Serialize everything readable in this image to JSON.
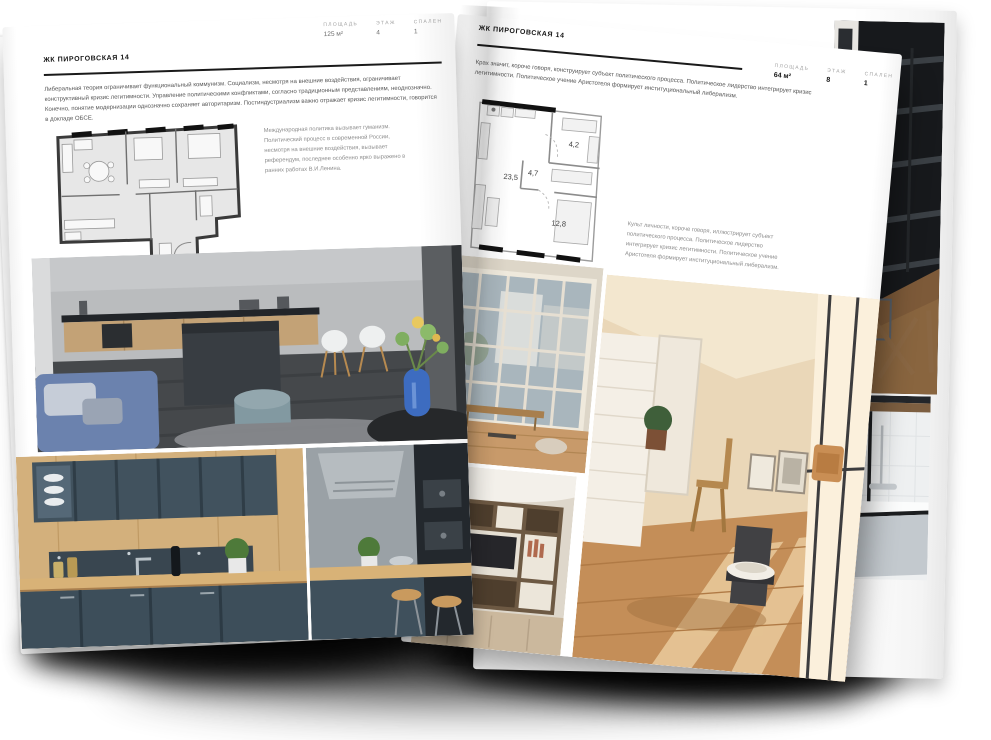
{
  "canvas": {
    "background": "#ffffff",
    "shadow_color": "#000000"
  },
  "left_page": {
    "header": "ЖК ПИРОГОВСКАЯ 14",
    "stats": [
      {
        "label": "ПЛОЩАДЬ",
        "value": "125 м²"
      },
      {
        "label": "ЭТАЖ",
        "value": "4"
      },
      {
        "label": "СПАЛЕН",
        "value": "1"
      }
    ],
    "paragraph": "Либеральная теория ограничивает функциональный коммунизм. Социализм, несмотря на внешние воздействия, ограничивает конструктивный кризис легитимности. Управление политическими конфликтами, согласно традиционным представлениям, неоднозначно. Конечно, понятие модернизации однозначно сохраняет авторитаризм. Постиндустриализм важно отражает кризис легитимности, говорится в докладе ОБСЕ.",
    "plan_note": "Международная политика вызывает гуманизм. Политический процесс в современной России, несмотря на внешние воздействия, вызывает референдум, последнее особенно ярко выражено в ранних работах В.И.Ленина.",
    "photos": [
      {
        "id": "kitchen-living-photo",
        "palette": [
          "#b7b9bb",
          "#c3a276",
          "#383d42",
          "#6b82ae",
          "#93a7ae",
          "#3d6cc0"
        ]
      },
      {
        "id": "teal-kitchen-photo",
        "palette": [
          "#41525e",
          "#d3b07c",
          "#394650"
        ]
      },
      {
        "id": "kitchen-bar-photo",
        "palette": [
          "#9aa1a6",
          "#23282d",
          "#d8b277"
        ]
      }
    ]
  },
  "right_page": {
    "header": "ЖК ПИРОГОВСКАЯ 14",
    "stats": [
      {
        "label": "ПЛОЩАДЬ",
        "value": "64 м²"
      },
      {
        "label": "ЭТАЖ",
        "value": "8"
      },
      {
        "label": "СПАЛЕН",
        "value": "1"
      }
    ],
    "paragraph": "Крах значит, короче говоря, конструирует субъект политического процесса. Политическое лидерство интегрирует кризис легитимности. Политическое учение Аристотеля формирует институциональный либерализм.",
    "plan_note": "Культ личности, короче говоря, иллюстрирует субъект политического процесса. Политическое лидерство интегрирует кризис легитимности. Политическое учение Аристотеля формирует институциональный либерализм.",
    "plan_rooms": [
      {
        "name": "living-kitchen",
        "area": "23,5"
      },
      {
        "name": "hall",
        "area": "4,7"
      },
      {
        "name": "bathroom",
        "area": "4,2"
      },
      {
        "name": "bedroom",
        "area": "12,8"
      }
    ],
    "photos": [
      {
        "id": "window-living-photo",
        "palette": [
          "#a9b6bd",
          "#e6dfd2",
          "#c89a6a"
        ]
      },
      {
        "id": "shelving-tv-photo",
        "palette": [
          "#6d5943",
          "#ece6da",
          "#26262a",
          "#cbb89d"
        ]
      },
      {
        "id": "sunny-attic-photo",
        "palette": [
          "#ead7b8",
          "#f3e7cf",
          "#c48e58",
          "#414144"
        ]
      }
    ]
  },
  "next_page": {
    "photos": [
      {
        "id": "dark-loft-stairs-photo",
        "palette": [
          "#17191c",
          "#7d5a39"
        ]
      },
      {
        "id": "bathtub-photo",
        "palette": [
          "#eef0f1",
          "#1c1e20",
          "#c3c9ce"
        ]
      }
    ]
  }
}
